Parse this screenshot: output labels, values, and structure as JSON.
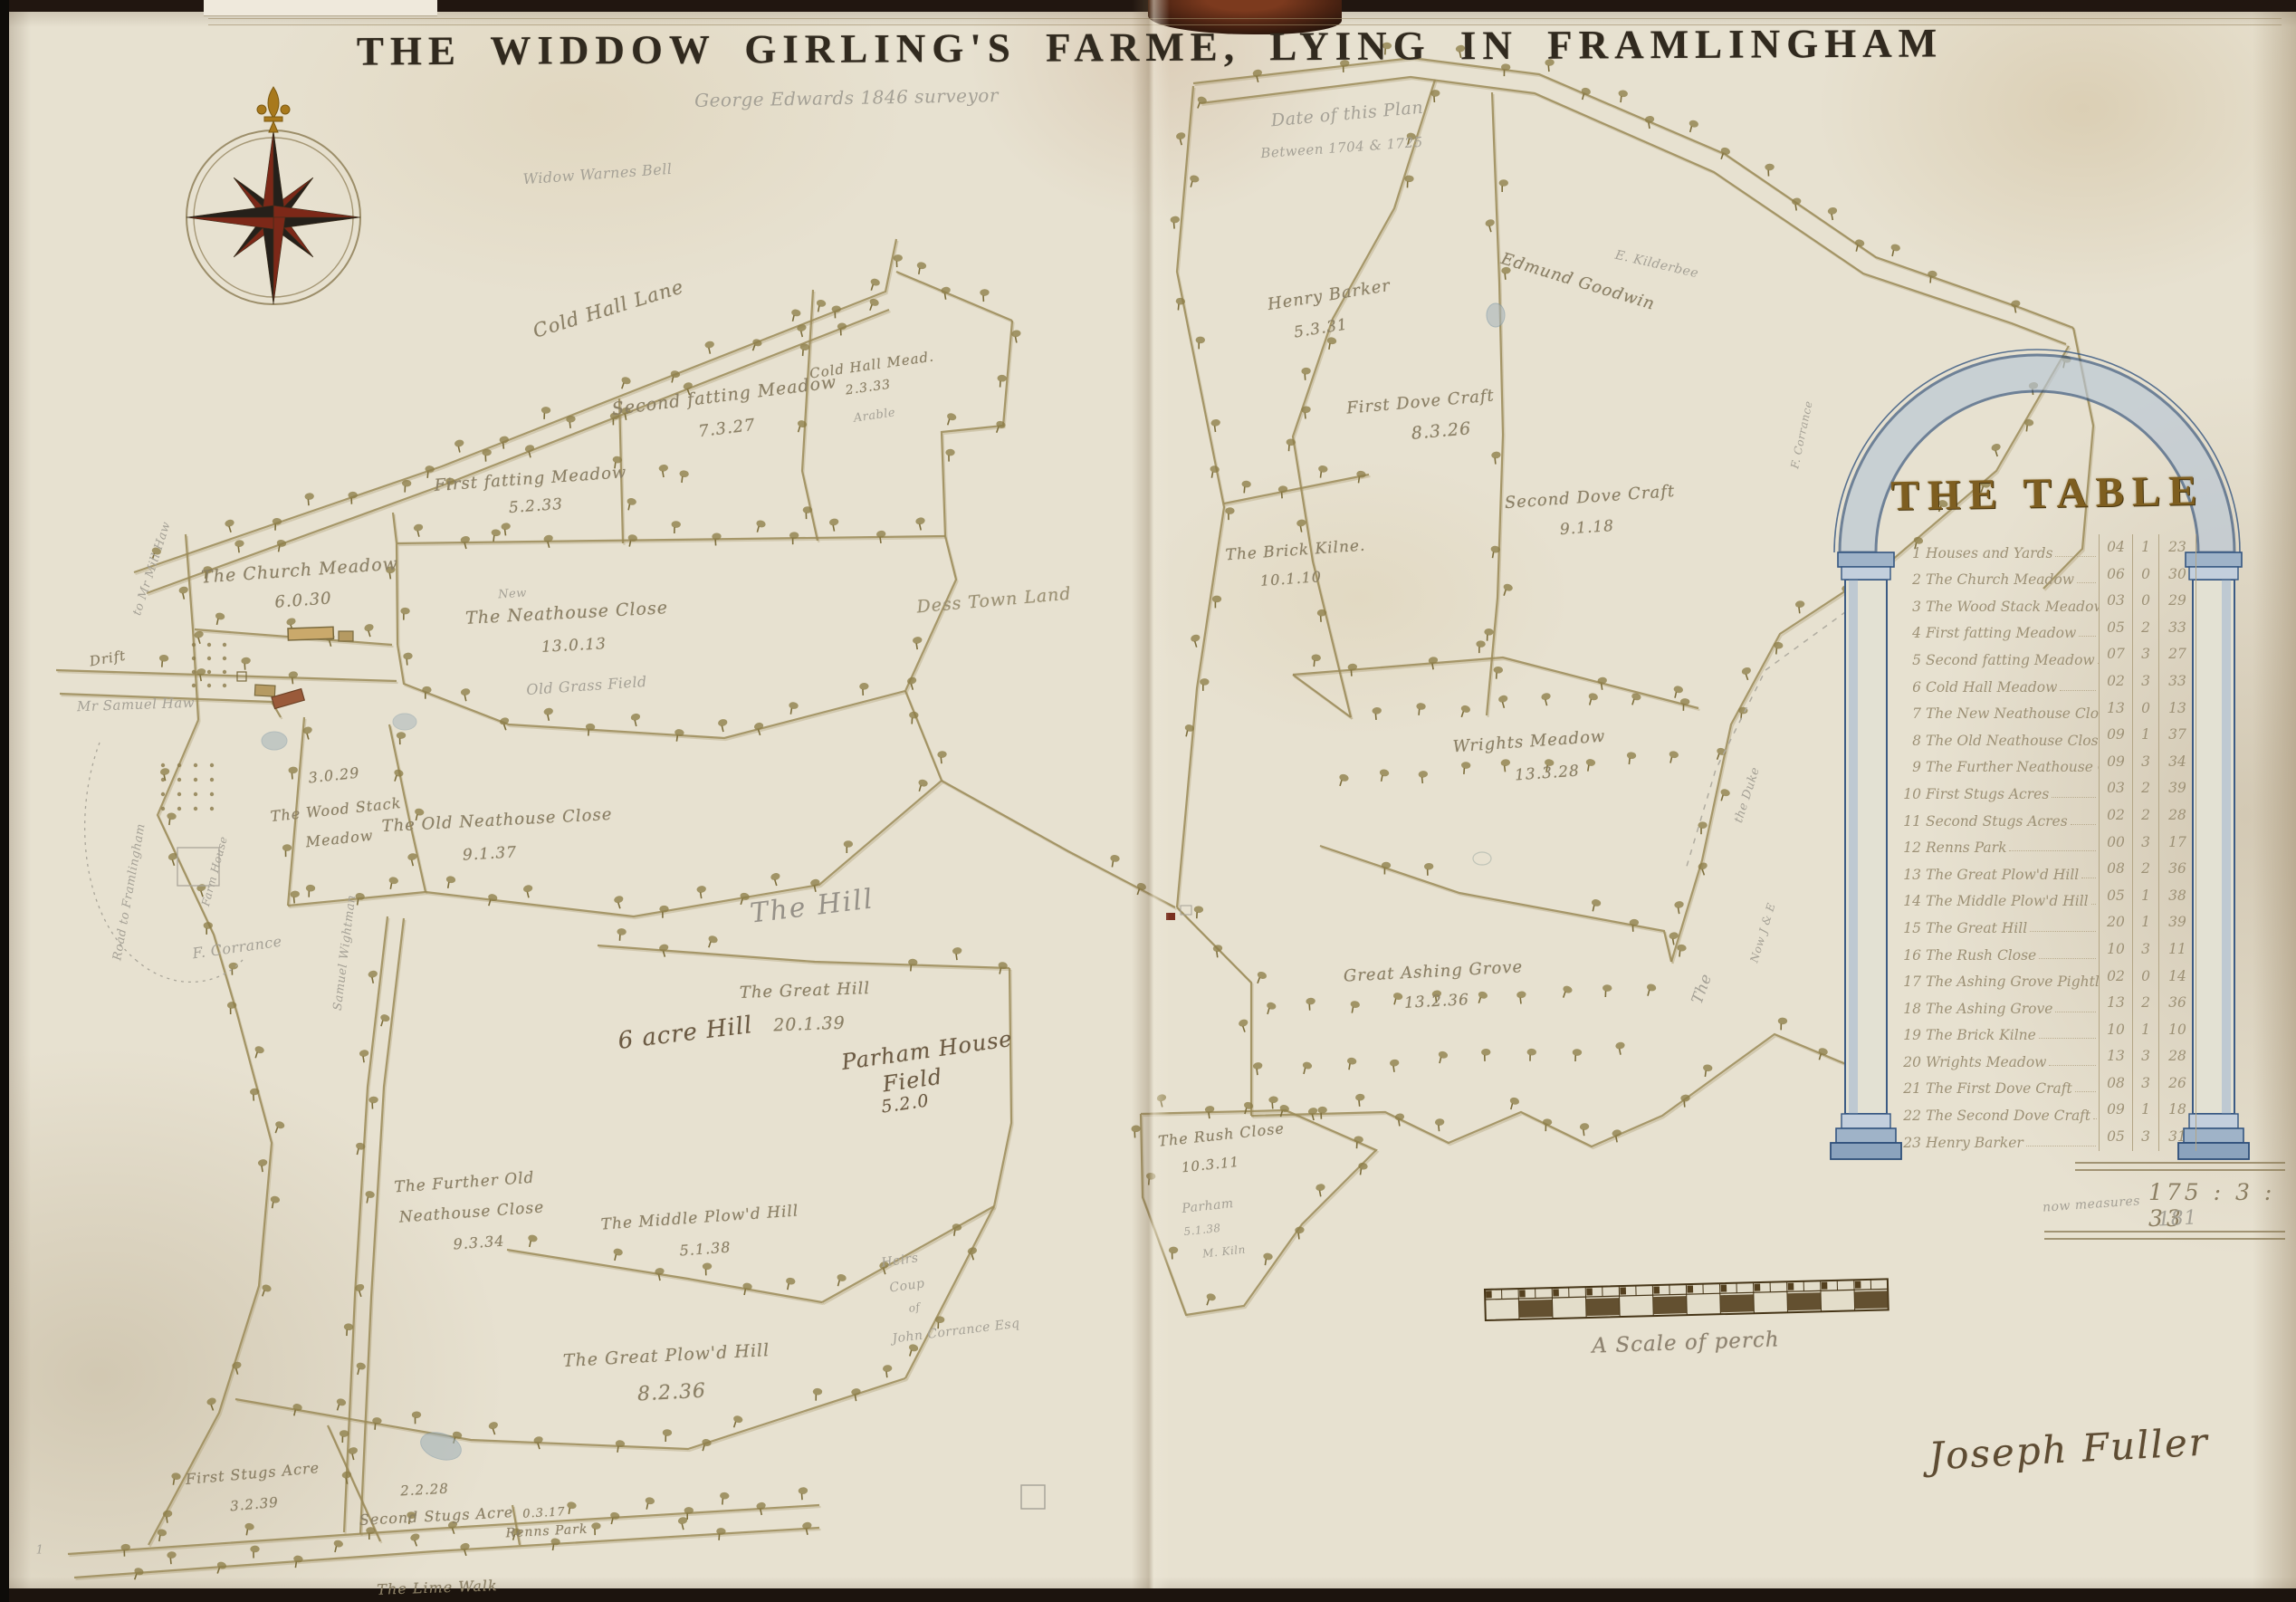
{
  "title": "THE WIDDOW GIRLING'S FARME, LYING IN FRAMLINGHAM",
  "inscriptions": {
    "surveyor_note": "George Edwards 1846 surveyor",
    "date_note": [
      "Date of this Plan",
      "Between 1704 & 1725"
    ],
    "widow_note": "Widow Warnes Bell",
    "scale_caption": "A Scale of perch",
    "signature": "Joseph Fuller",
    "page_number": "1"
  },
  "table": {
    "header": "THE TABLE",
    "rows": [
      {
        "num": "1",
        "name": "Houses and Yards",
        "a": "04",
        "r": "1",
        "p": "23"
      },
      {
        "num": "2",
        "name": "The Church Meadow",
        "a": "06",
        "r": "0",
        "p": "30"
      },
      {
        "num": "3",
        "name": "The Wood Stack Meadow",
        "a": "03",
        "r": "0",
        "p": "29"
      },
      {
        "num": "4",
        "name": "First fatting Meadow",
        "a": "05",
        "r": "2",
        "p": "33"
      },
      {
        "num": "5",
        "name": "Second fatting Meadow",
        "a": "07",
        "r": "3",
        "p": "27"
      },
      {
        "num": "6",
        "name": "Cold Hall Meadow",
        "a": "02",
        "r": "3",
        "p": "33"
      },
      {
        "num": "7",
        "name": "The New Neathouse Close",
        "a": "13",
        "r": "0",
        "p": "13"
      },
      {
        "num": "8",
        "name": "The Old Neathouse Close",
        "a": "09",
        "r": "1",
        "p": "37"
      },
      {
        "num": "9",
        "name": "The Further Neathouse Close",
        "a": "09",
        "r": "3",
        "p": "34"
      },
      {
        "num": "10",
        "name": "First Stugs Acres",
        "a": "03",
        "r": "2",
        "p": "39"
      },
      {
        "num": "11",
        "name": "Second Stugs Acres",
        "a": "02",
        "r": "2",
        "p": "28"
      },
      {
        "num": "12",
        "name": "Renns Park",
        "a": "00",
        "r": "3",
        "p": "17"
      },
      {
        "num": "13",
        "name": "The Great Plow'd Hill",
        "a": "08",
        "r": "2",
        "p": "36"
      },
      {
        "num": "14",
        "name": "The Middle Plow'd Hill",
        "a": "05",
        "r": "1",
        "p": "38"
      },
      {
        "num": "15",
        "name": "The Great Hill",
        "a": "20",
        "r": "1",
        "p": "39"
      },
      {
        "num": "16",
        "name": "The Rush Close",
        "a": "10",
        "r": "3",
        "p": "11"
      },
      {
        "num": "17",
        "name": "The Ashing Grove Pightle",
        "a": "02",
        "r": "0",
        "p": "14"
      },
      {
        "num": "18",
        "name": "The Ashing Grove",
        "a": "13",
        "r": "2",
        "p": "36"
      },
      {
        "num": "19",
        "name": "The Brick Kilne",
        "a": "10",
        "r": "1",
        "p": "10"
      },
      {
        "num": "20",
        "name": "Wrights Meadow",
        "a": "13",
        "r": "3",
        "p": "28"
      },
      {
        "num": "21",
        "name": "The First Dove Craft",
        "a": "08",
        "r": "3",
        "p": "26"
      },
      {
        "num": "22",
        "name": "The Second Dove Craft",
        "a": "09",
        "r": "1",
        "p": "18"
      },
      {
        "num": "23",
        "name": "Henry Barker",
        "a": "05",
        "r": "3",
        "p": "31"
      }
    ],
    "total": "175 : 3 : 33",
    "pencil_note": "now measures",
    "pencil_total": "181"
  },
  "map": {
    "fields": [
      {
        "id": "cold-hall-lane",
        "name": "Cold Hall Lane",
        "lines": [
          "Cold Hall Lane"
        ]
      },
      {
        "id": "first-fatting-meadow",
        "name": "First fatting Meadow",
        "area": "5.2.33",
        "lines": [
          "First fatting Meadow",
          "5.2.33"
        ]
      },
      {
        "id": "second-fatting-meadow",
        "name": "Second fatting Meadow",
        "area": "7.3.27",
        "lines": [
          "Second fatting Meadow",
          "7.3.27"
        ]
      },
      {
        "id": "cold-hall-mead",
        "name": "Cold Hall Mead.",
        "area": "2.3.33",
        "lines": [
          "Cold Hall Mead.",
          "2.3.33"
        ]
      },
      {
        "id": "church-meadow",
        "name": "The Church Meadow",
        "area": "6.0.30",
        "lines": [
          "The Church Meadow",
          "6.0.30"
        ]
      },
      {
        "id": "new-neathouse-close",
        "name": "The Neathouse Close",
        "area": "13.0.13",
        "lines": [
          "The Neathouse Close",
          "13.0.13"
        ]
      },
      {
        "id": "dess-town-land",
        "name": "Dess Town Land",
        "lines": [
          "Dess Town Land"
        ]
      },
      {
        "id": "wood-stack-meadow",
        "name": "The Wood Stack Meadow",
        "area": "3.0.29",
        "lines": [
          "3.0.29",
          "The Wood Stack",
          "Meadow"
        ]
      },
      {
        "id": "old-neathouse-close",
        "name": "The Old Neathouse Close",
        "area": "9.1.37",
        "lines": [
          "The Old Neathouse Close",
          "9.1.37"
        ]
      },
      {
        "id": "drift-lane",
        "name": "Drift",
        "lines": [
          "Drift"
        ]
      },
      {
        "id": "further-old-neathouse-close",
        "name": "The Further Old Neathouse Close",
        "area": "9.3.34",
        "lines": [
          "The Further Old",
          "Neathouse Close",
          "9.3.34"
        ]
      },
      {
        "id": "middle-plowd-hill",
        "name": "The Middle Plow'd Hill",
        "area": "5.1.38",
        "lines": [
          "The Middle Plow'd Hill",
          "5.1.38"
        ]
      },
      {
        "id": "great-plowd-hill",
        "name": "The Great Plow'd Hill",
        "area": "8.2.36",
        "lines": [
          "The Great Plow'd Hill",
          "8.2.36"
        ]
      },
      {
        "id": "first-stugs-acre",
        "name": "First Stugs Acre",
        "area": "3.2.39",
        "lines": [
          "First Stugs Acre",
          "3.2.39"
        ]
      },
      {
        "id": "second-stugs-acre",
        "name": "Second Stugs Acre",
        "area": "2.2.28",
        "lines": [
          "2.2.28",
          "Second Stugs Acre"
        ]
      },
      {
        "id": "renns-park",
        "name": "Renns Park",
        "area": "0.3.17",
        "lines": [
          "0.3.17",
          "Renns Park"
        ]
      },
      {
        "id": "lime-walk",
        "name": "The Lime Walk",
        "lines": [
          "The Lime Walk"
        ]
      },
      {
        "id": "the-hill",
        "name": "The Hill",
        "lines": [
          "The Hill"
        ]
      },
      {
        "id": "great-hill",
        "name": "The Great Hill",
        "area": "20.1.39",
        "lines": [
          "The Great Hill",
          "20.1.39"
        ]
      },
      {
        "id": "six-acre-hill",
        "name": "6 acre Hill",
        "lines": [
          "6 acre Hill"
        ]
      },
      {
        "id": "parham-house-field",
        "name": "Parham House Field",
        "area": "5.2.0",
        "lines": [
          "Parham House",
          "Field",
          "5.2.0"
        ]
      },
      {
        "id": "henry-barker",
        "name": "Henry Barker",
        "area": "5.3.31",
        "lines": [
          "Henry Barker",
          "5.3.31"
        ]
      },
      {
        "id": "edmund-goodwin",
        "name": "Edmund Goodwin",
        "lines": [
          "Edmund Goodwin"
        ]
      },
      {
        "id": "first-dove-craft",
        "name": "First Dove Craft",
        "area": "8.3.26",
        "lines": [
          "First Dove Craft",
          "8.3.26"
        ]
      },
      {
        "id": "second-dove-craft",
        "name": "Second Dove Craft",
        "area": "9.1.18",
        "lines": [
          "Second Dove Craft",
          "9.1.18"
        ]
      },
      {
        "id": "brick-kilne",
        "name": "The Brick Kilne.",
        "area": "10.1.10",
        "lines": [
          "The Brick Kilne.",
          "10.1.10"
        ]
      },
      {
        "id": "wrights-meadow",
        "name": "Wrights Meadow",
        "area": "13.3.28",
        "lines": [
          "Wrights Meadow",
          "13.3.28"
        ]
      },
      {
        "id": "great-ashing-grove",
        "name": "Great Ashing Grove",
        "area": "13.2.36",
        "lines": [
          "Great Ashing Grove",
          "13.2.36"
        ]
      },
      {
        "id": "rush-close",
        "name": "The Rush Close",
        "area": "10.3.11",
        "lines": [
          "The Rush Close",
          "10.3.11"
        ]
      }
    ],
    "pencil_notes": [
      {
        "id": "new-prefix",
        "text": "New"
      },
      {
        "id": "old-grass-field",
        "text": "Old Grass Field"
      },
      {
        "id": "arable",
        "text": "Arable"
      },
      {
        "id": "samuel-haw",
        "text": "Mr Samuel Haw"
      },
      {
        "id": "mill-haw",
        "text": "to Mr Mill Haw"
      },
      {
        "id": "road-to-framlingham",
        "text": "Road to Framlingham"
      },
      {
        "id": "samuel-wightman",
        "text": "Samuel Wightman"
      },
      {
        "id": "f-corrance",
        "text": "F. Corrance"
      },
      {
        "id": "farm-house",
        "text": "Farm House"
      },
      {
        "id": "kilderbee",
        "text": "E. Kilderbee"
      },
      {
        "id": "heirs-1",
        "text": "Heirs"
      },
      {
        "id": "heirs-2",
        "text": "Coup"
      },
      {
        "id": "heirs-3",
        "text": "of"
      },
      {
        "id": "heirs-4",
        "text": "John Corrance Esq"
      },
      {
        "id": "parham-1",
        "text": "Parham"
      },
      {
        "id": "parham-2",
        "text": "5.1.38"
      },
      {
        "id": "parham-3",
        "text": "M. Kiln"
      },
      {
        "id": "the-duke",
        "text": "the Duke"
      },
      {
        "id": "the-big",
        "text": "The"
      },
      {
        "id": "now-je",
        "text": "Now J & E"
      },
      {
        "id": "f-corrance-right",
        "text": "F. Corrance"
      }
    ]
  },
  "colors": {
    "parchment": "#e7e1d0",
    "ink": "#8b8066",
    "hedge": "#9a8a57",
    "table_gold": "#7e5e20",
    "arch_blue": "#345580",
    "compass_red": "#7c2818",
    "compass_dark": "#25201a"
  }
}
